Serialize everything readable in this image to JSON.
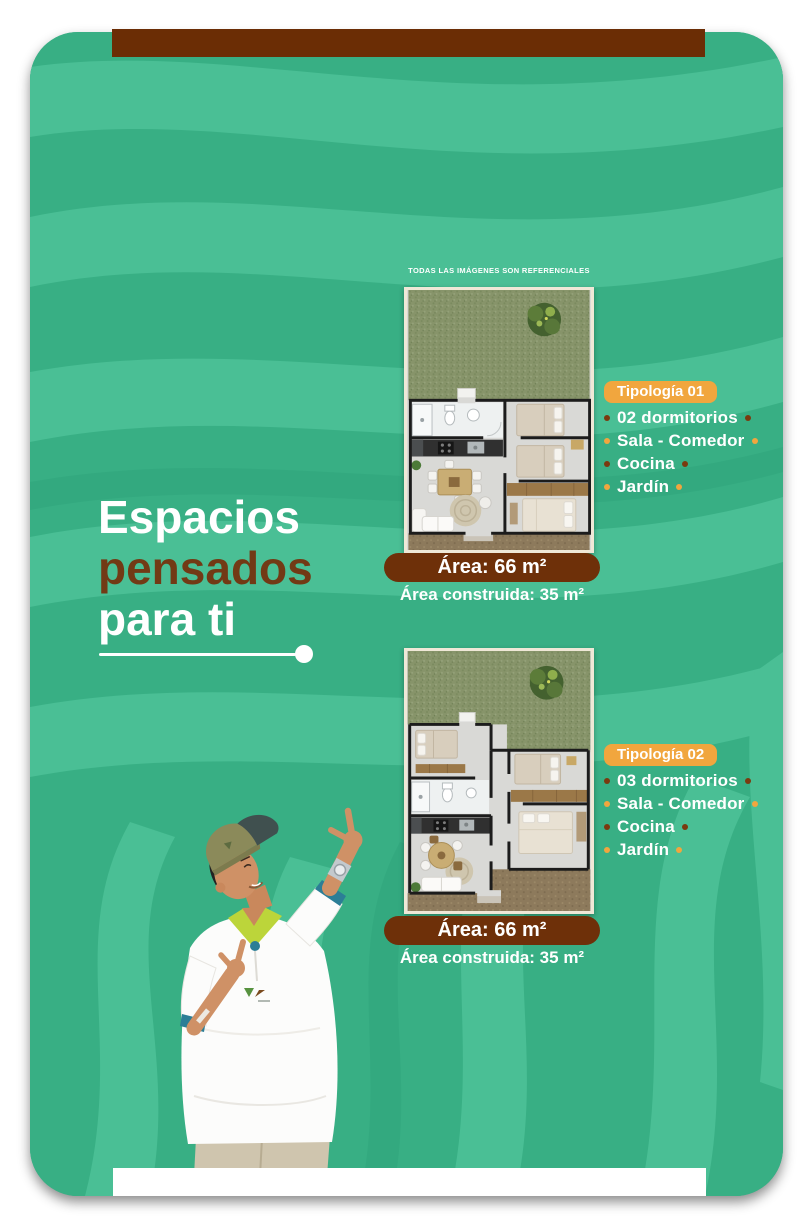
{
  "flyer": {
    "disclaimer": "TODAS LAS IMÁGENES SON REFERENCIALES",
    "heading": {
      "line1": "Espacios",
      "line2": "pensados",
      "line3": "para ti"
    },
    "typologies": [
      {
        "name": "Tipología 01",
        "features": [
          "02 dormitorios",
          "Sala - Comedor",
          "Cocina",
          "Jardín"
        ],
        "area": "Área: 66 m²",
        "built_area": "Área construida: 35 m²"
      },
      {
        "name": "Tipología 02",
        "features": [
          "03 dormitorios",
          "Sala - Comedor",
          "Cocina",
          "Jardín"
        ],
        "area": "Área: 66 m²",
        "built_area": "Área construida: 35 m²"
      }
    ],
    "colors": {
      "page_background": "#ffffff",
      "card_teal": "#38af84",
      "wave_light": "#4abf95",
      "wave_dark": "#2fa47b",
      "bar_brown": "#6b2d05",
      "area_badge_brown": "#6e3009",
      "heading_brown": "#723a15",
      "accent_orange": "#f1a63e",
      "bullet_brown": "#7a3a0f",
      "text_white": "#ffffff"
    },
    "images": {
      "floorplan_1": "aerial-floorplan-2-bedroom-house-with-garden",
      "floorplan_2": "aerial-floorplan-3-bedroom-house-with-garden",
      "person": "man-in-cap-pointing-up"
    }
  }
}
